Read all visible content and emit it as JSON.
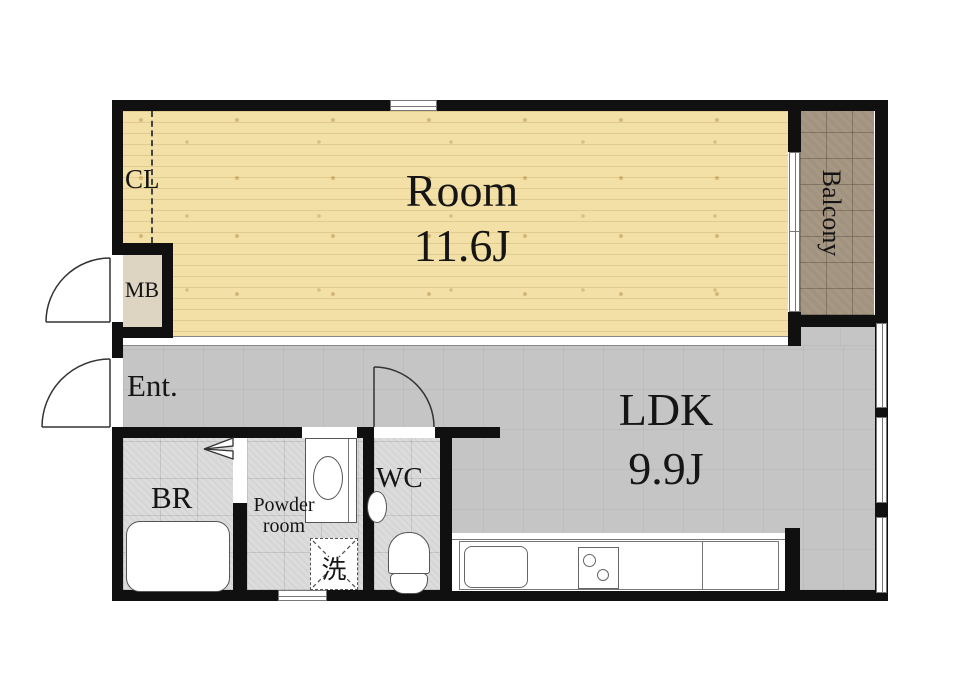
{
  "title": "1LDK apartment floor plan",
  "rooms": {
    "main_room": {
      "name": "Room",
      "area": "11.6J"
    },
    "ldk": {
      "name": "LDK",
      "area": "9.9J"
    },
    "balcony": {
      "name": "Balcony"
    },
    "entrance": {
      "name": "Ent."
    },
    "closet": {
      "name": "CL"
    },
    "meter_box": {
      "name": "MB"
    },
    "bathroom": {
      "name": "BR"
    },
    "powder_room": {
      "name": "Powder room"
    },
    "toilet_room": {
      "name": "WC"
    },
    "washer": {
      "name": "洗"
    }
  },
  "colors": {
    "wall": "#101010",
    "wood": "#f2e0a6",
    "ldk": "#c5c5c5",
    "tile": "#dcdcdc",
    "balcony": "#a2937f",
    "mb": "#ddd5c2"
  }
}
